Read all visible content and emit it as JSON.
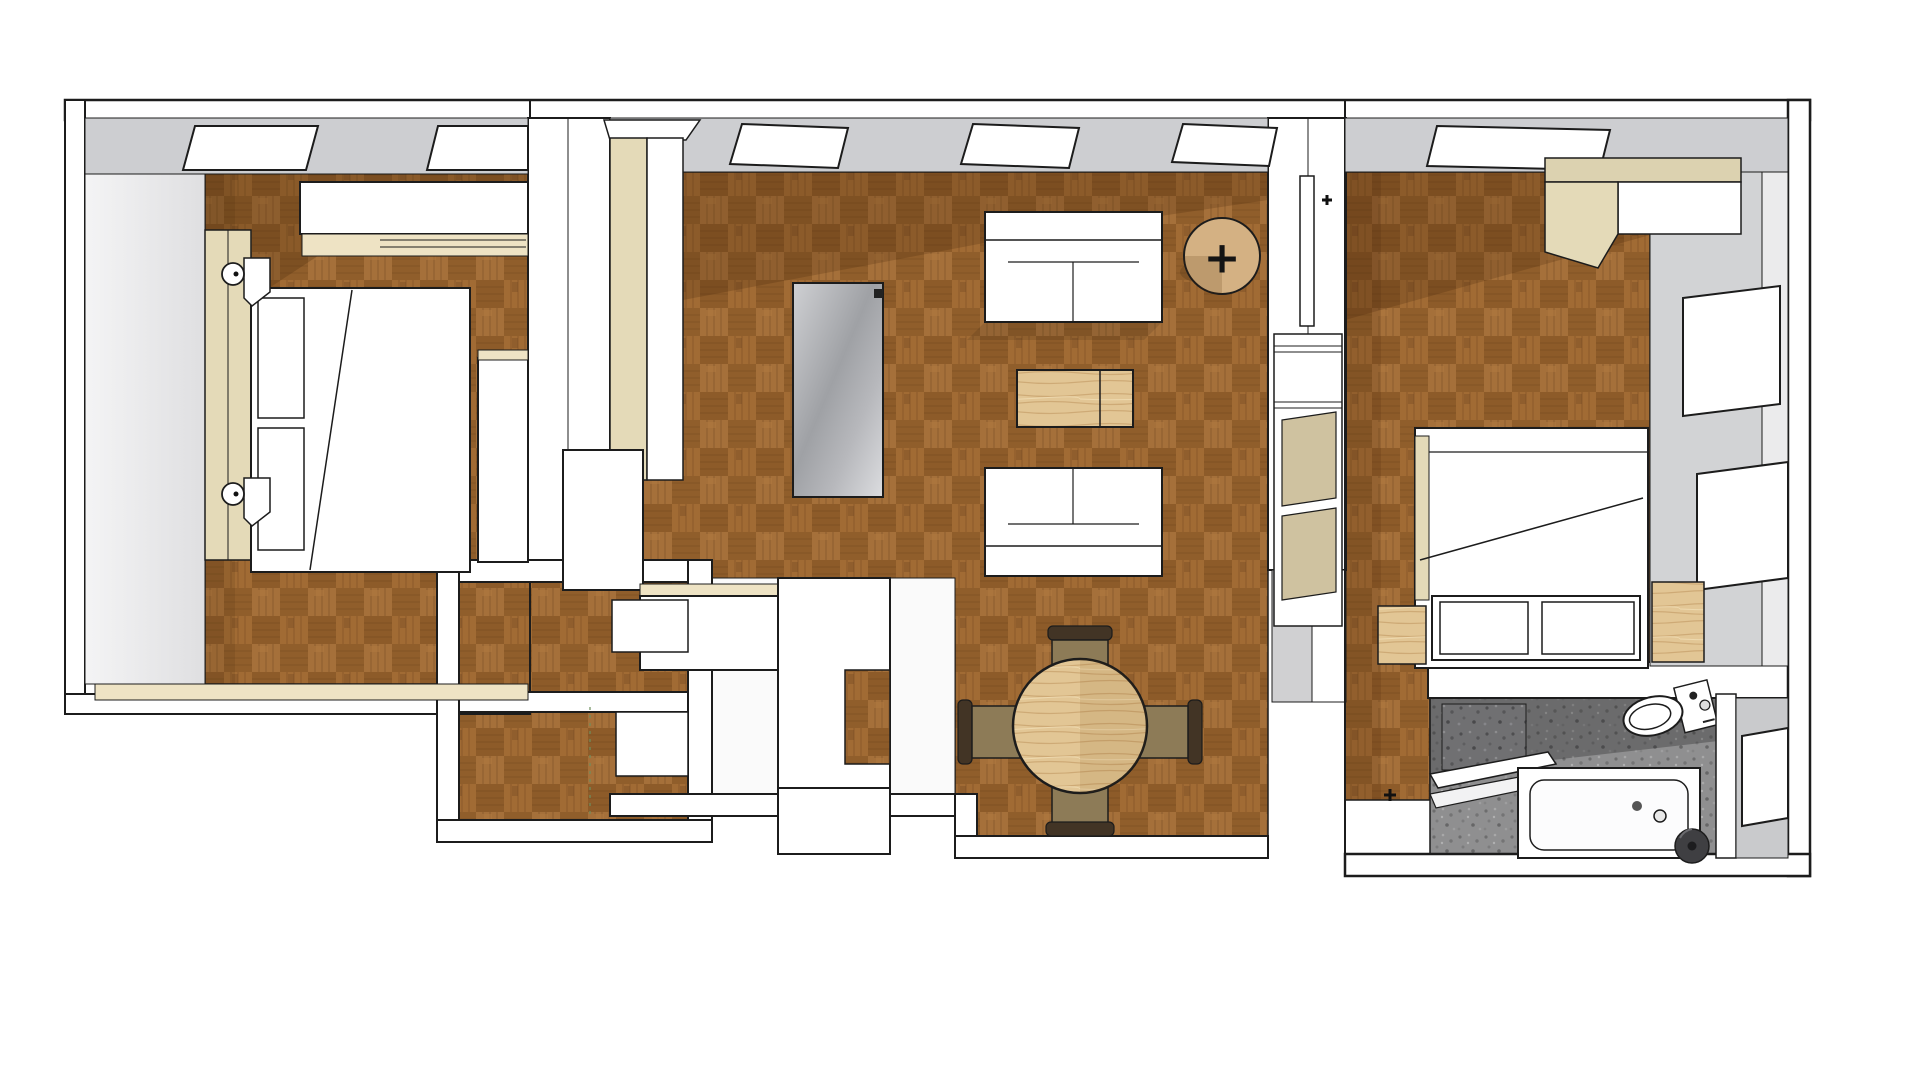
{
  "scene": {
    "type": "3d-floorplan-render",
    "description": "Axonometric top-down 3D render of a two-bedroom apartment with parquet floors",
    "markers": {
      "side_table_plus": "+"
    },
    "rooms": [
      {
        "id": "bedroom-left",
        "label": "left bedroom",
        "floor": "brown parquet",
        "furniture": [
          "sliding wardrobe",
          "double bed",
          "headboard",
          "pillows",
          "wall sconce x2",
          "dresser",
          "window ledge"
        ]
      },
      {
        "id": "living-room",
        "label": "living room",
        "floor": "brown parquet",
        "furniture": [
          "tall cabinet",
          "media panel",
          "sofa x2",
          "wood coffee table",
          "round side table",
          "wall shelf unit"
        ]
      },
      {
        "id": "dining-area",
        "label": "dining area",
        "floor": "brown parquet",
        "furniture": [
          "round dining table",
          "dining chair x4"
        ]
      },
      {
        "id": "hallway",
        "label": "hallway",
        "floor": "white"
      },
      {
        "id": "storage-rooms",
        "label": "storage / wc",
        "floor": "brown parquet",
        "furniture": [
          "shelf box x2"
        ]
      },
      {
        "id": "bedroom-right",
        "label": "right bedroom",
        "floor": "brown parquet",
        "furniture": [
          "corner wardrobe",
          "double bed",
          "footboard panels",
          "nightstand x2"
        ]
      },
      {
        "id": "bathroom",
        "label": "bathroom",
        "floor": "gray mosaic tile",
        "furniture": [
          "toilet",
          "bathtub",
          "dark stool",
          "shower ledge"
        ]
      }
    ],
    "window_counts": {
      "top_wall": 6,
      "right_wall": 3
    }
  },
  "colors": {
    "background": "#ffffff",
    "wall_white": "#ffffff",
    "wall_gray": "#cdced1",
    "wall_gray_right": "#d2d3d5",
    "wall_gray_light": "#e9e9ea",
    "outline": "#1c1c1c",
    "parquet_base": "#99652f",
    "beige": "#eee3c4",
    "tan_panel": "#e4dab8",
    "tan_top": "#dcd2b0",
    "glass_tan": "#cfc2a0",
    "light_wood": "#e2c695",
    "side_table_wood": "#d4b183",
    "chair_frame": "#423425",
    "chair_seat": "#8d7b57",
    "tile_gray": "#8f8f90",
    "stool_dark": "#3f3f42",
    "dash_green": "#6f8f5f"
  }
}
